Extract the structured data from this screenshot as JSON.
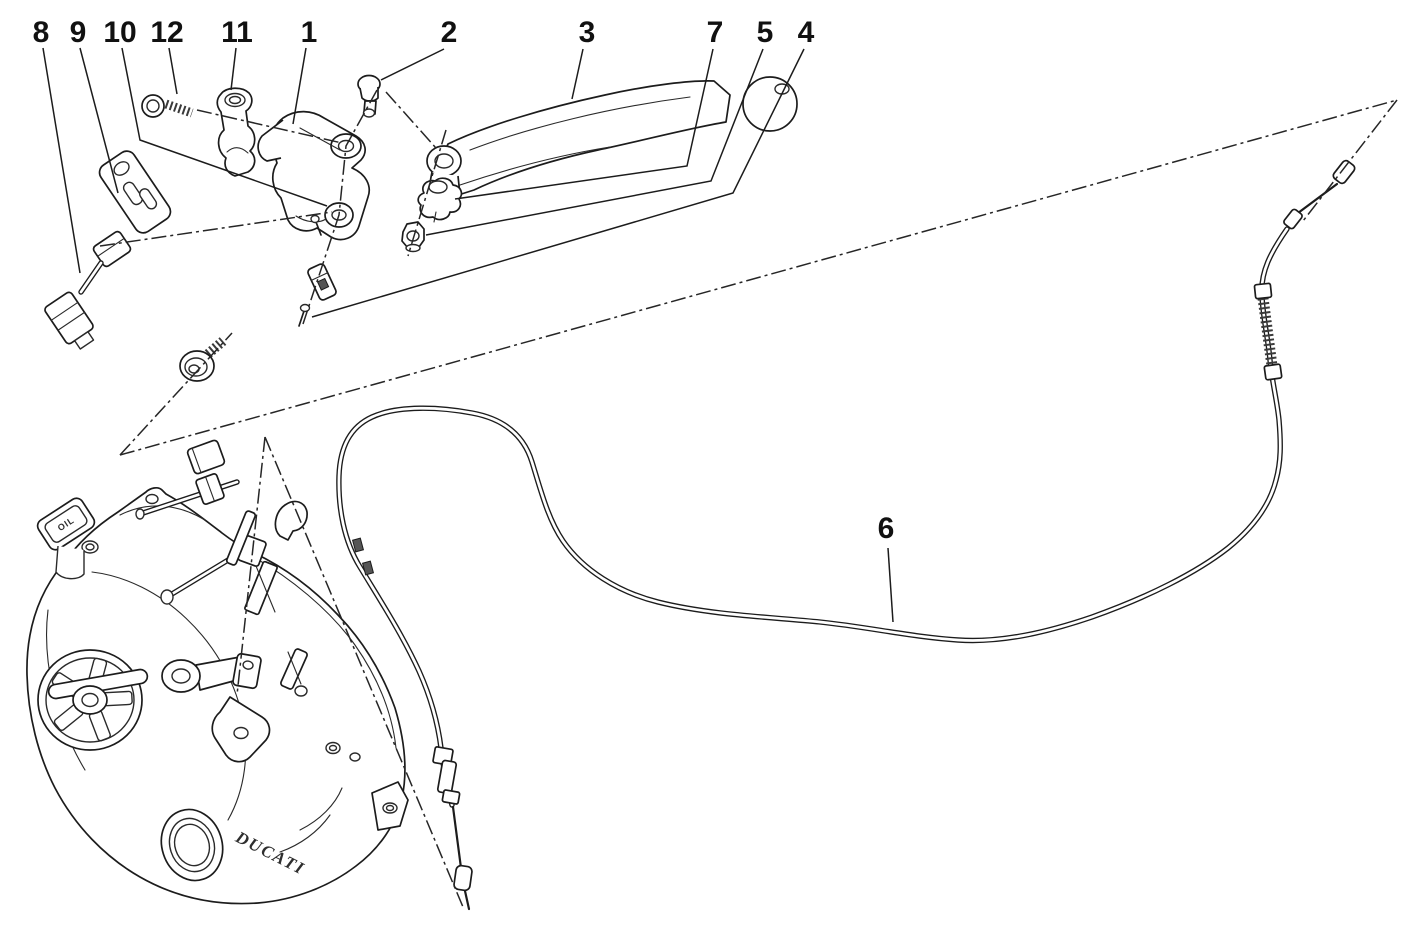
{
  "figure": {
    "type": "exploded-parts-diagram",
    "subject": "motorcycle clutch control",
    "background": "#ffffff",
    "ink_color": "#1c1c1c"
  },
  "texts": {
    "engine_logo": "DUCATI",
    "oil_cap_label": "OIL"
  },
  "style": {
    "label_font_px": 30,
    "leader_width": 1.5,
    "centerline_dash": "15 4 3 4"
  },
  "callouts": [
    {
      "num": "8",
      "lx": 41,
      "ly": 32,
      "leader": [
        [
          43,
          48
        ],
        [
          80,
          273
        ]
      ]
    },
    {
      "num": "9",
      "lx": 78,
      "ly": 32,
      "leader": [
        [
          80,
          48
        ],
        [
          118,
          193
        ]
      ]
    },
    {
      "num": "10",
      "lx": 120,
      "ly": 32,
      "leader": [
        [
          122,
          48
        ],
        [
          140,
          140
        ],
        [
          327,
          206
        ]
      ]
    },
    {
      "num": "12",
      "lx": 167,
      "ly": 32,
      "leader": [
        [
          169,
          48
        ],
        [
          177,
          94
        ]
      ]
    },
    {
      "num": "11",
      "lx": 237,
      "ly": 32,
      "leader": [
        [
          236,
          48
        ],
        [
          231,
          90
        ]
      ]
    },
    {
      "num": "1",
      "lx": 309,
      "ly": 32,
      "leader": [
        [
          306,
          48
        ],
        [
          293,
          124
        ]
      ]
    },
    {
      "num": "2",
      "lx": 449,
      "ly": 32,
      "leader": [
        [
          444,
          49
        ],
        [
          381,
          80
        ]
      ]
    },
    {
      "num": "3",
      "lx": 587,
      "ly": 32,
      "leader": [
        [
          583,
          49
        ],
        [
          572,
          99
        ]
      ]
    },
    {
      "num": "7",
      "lx": 715,
      "ly": 32,
      "leader": [
        [
          713,
          49
        ],
        [
          687,
          166
        ],
        [
          455,
          199
        ]
      ]
    },
    {
      "num": "5",
      "lx": 765,
      "ly": 32,
      "leader": [
        [
          763,
          49
        ],
        [
          711,
          181
        ],
        [
          426,
          235
        ]
      ]
    },
    {
      "num": "4",
      "lx": 806,
      "ly": 32,
      "leader": [
        [
          804,
          49
        ],
        [
          733,
          193
        ],
        [
          312,
          317
        ]
      ]
    },
    {
      "num": "6",
      "lx": 886,
      "ly": 528,
      "leader": [
        [
          888,
          548
        ],
        [
          893,
          622
        ]
      ]
    }
  ],
  "centerlines": [
    {
      "name": "main-horizontal-axis",
      "points": [
        [
          120,
          455
        ],
        [
          1397,
          100
        ]
      ]
    },
    {
      "name": "cable-top-end-axis",
      "points": [
        [
          1397,
          100
        ],
        [
          1303,
          221
        ]
      ]
    },
    {
      "name": "adjuster-bolt-axis",
      "points": [
        [
          120,
          455
        ],
        [
          232,
          333
        ]
      ]
    },
    {
      "name": "switch-assembly-axis",
      "points": [
        [
          100,
          246
        ],
        [
          332,
          212
        ]
      ]
    },
    {
      "name": "bracket-vertical-axis",
      "points": [
        [
          377,
          90
        ],
        [
          346,
          146
        ],
        [
          339,
          215
        ],
        [
          303,
          324
        ]
      ]
    },
    {
      "name": "clamp-screw-axis",
      "points": [
        [
          197,
          110
        ],
        [
          342,
          143
        ]
      ]
    },
    {
      "name": "engine-linkage-axis",
      "points": [
        [
          265,
          437
        ],
        [
          237,
          695
        ]
      ]
    },
    {
      "name": "cable-lower-end-axis",
      "points": [
        [
          265,
          437
        ],
        [
          463,
          907
        ]
      ]
    },
    {
      "name": "lever-pivot-axis",
      "points": [
        [
          446,
          130
        ],
        [
          408,
          256
        ]
      ]
    },
    {
      "name": "pivot-screw-axis",
      "points": [
        [
          386,
          92
        ],
        [
          436,
          148
        ]
      ]
    }
  ]
}
